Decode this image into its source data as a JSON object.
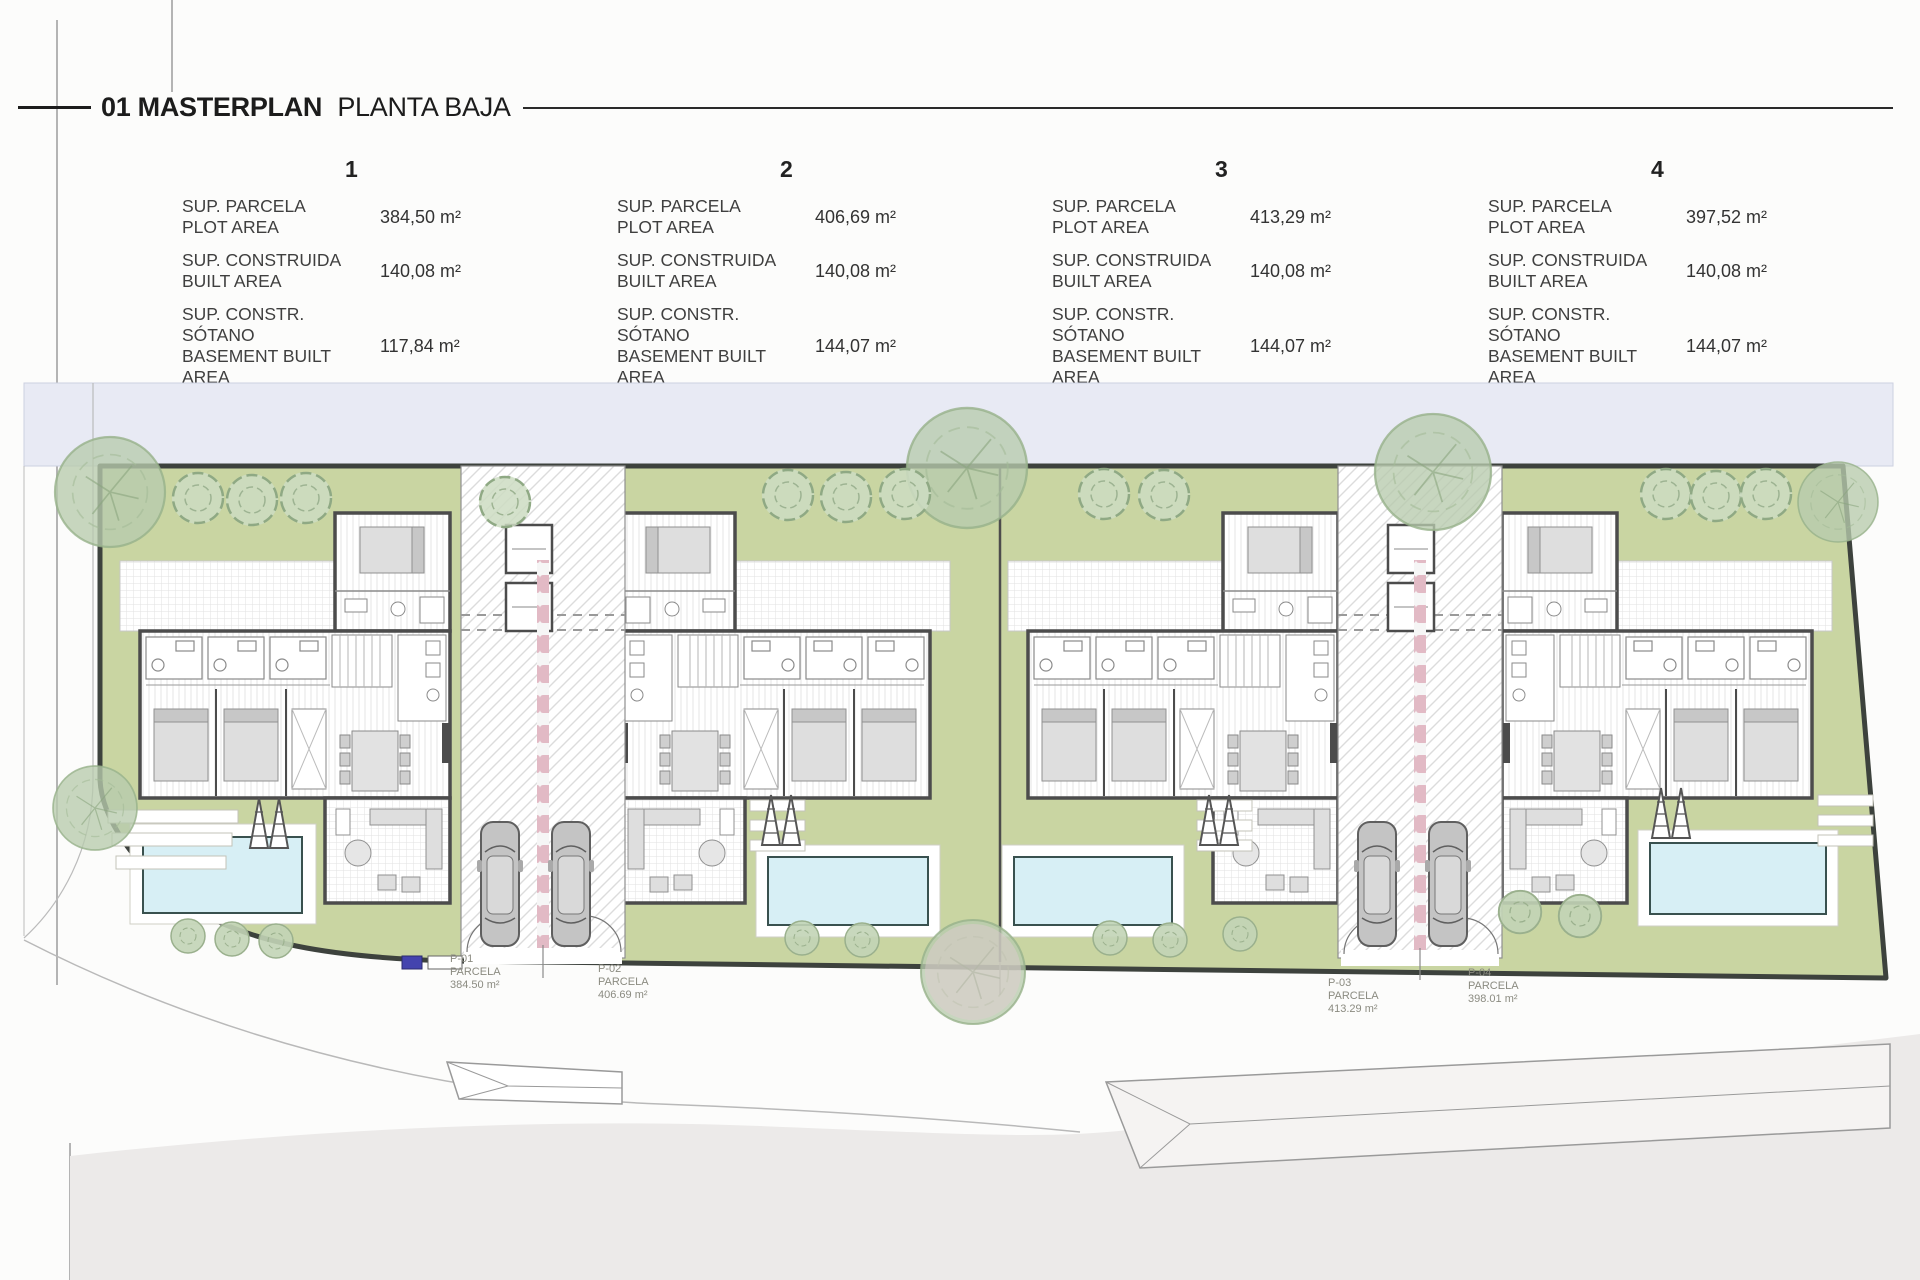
{
  "page": {
    "title_bold": "01 MASTERPLAN",
    "title_regular": "PLANTA BAJA"
  },
  "units": [
    {
      "number": "1",
      "rows": [
        {
          "label_es": "SUP. PARCELA",
          "label_en": "PLOT AREA",
          "value": "384,50 m²"
        },
        {
          "label_es": "SUP. CONSTRUIDA",
          "label_en": "BUILT AREA",
          "value": "140,08 m²"
        },
        {
          "label_es": "SUP. CONSTR. SÓTANO",
          "label_en": "BASEMENT BUILT AREA",
          "value": "117,84 m²"
        }
      ]
    },
    {
      "number": "2",
      "rows": [
        {
          "label_es": "SUP. PARCELA",
          "label_en": "PLOT AREA",
          "value": "406,69 m²"
        },
        {
          "label_es": "SUP. CONSTRUIDA",
          "label_en": "BUILT AREA",
          "value": "140,08 m²"
        },
        {
          "label_es": "SUP. CONSTR. SÓTANO",
          "label_en": "BASEMENT BUILT AREA",
          "value": "144,07 m²"
        }
      ]
    },
    {
      "number": "3",
      "rows": [
        {
          "label_es": "SUP. PARCELA",
          "label_en": "PLOT AREA",
          "value": "413,29 m²"
        },
        {
          "label_es": "SUP. CONSTRUIDA",
          "label_en": "BUILT AREA",
          "value": "140,08 m²"
        },
        {
          "label_es": "SUP. CONSTR. SÓTANO",
          "label_en": "BASEMENT BUILT AREA",
          "value": "144,07 m²"
        }
      ]
    },
    {
      "number": "4",
      "rows": [
        {
          "label_es": "SUP. PARCELA",
          "label_en": "PLOT AREA",
          "value": "397,52 m²"
        },
        {
          "label_es": "SUP. CONSTRUIDA",
          "label_en": "BUILT AREA",
          "value": "140,08 m²"
        },
        {
          "label_es": "SUP. CONSTR. SÓTANO",
          "label_en": "BASEMENT BUILT AREA",
          "value": "144,07 m²"
        }
      ]
    }
  ],
  "plan": {
    "parcels": [
      {
        "id": "P-01",
        "type": "PARCELA",
        "area": "384.50 m²"
      },
      {
        "id": "P-02",
        "type": "PARCELA",
        "area": "406.69 m²"
      },
      {
        "id": "P-03",
        "type": "PARCELA",
        "area": "413.29 m²"
      },
      {
        "id": "P-04",
        "type": "PARCELA",
        "area": "398.01 m²"
      }
    ],
    "colors": {
      "street": "#e8eaf4",
      "garden": "#c9d5a2",
      "pool_water": "#d7eff5",
      "tree": "#b7cbad",
      "wall": "#4c4c4c",
      "road": "#eceae9",
      "parcel_divider_pink": "#e2bac5"
    }
  }
}
